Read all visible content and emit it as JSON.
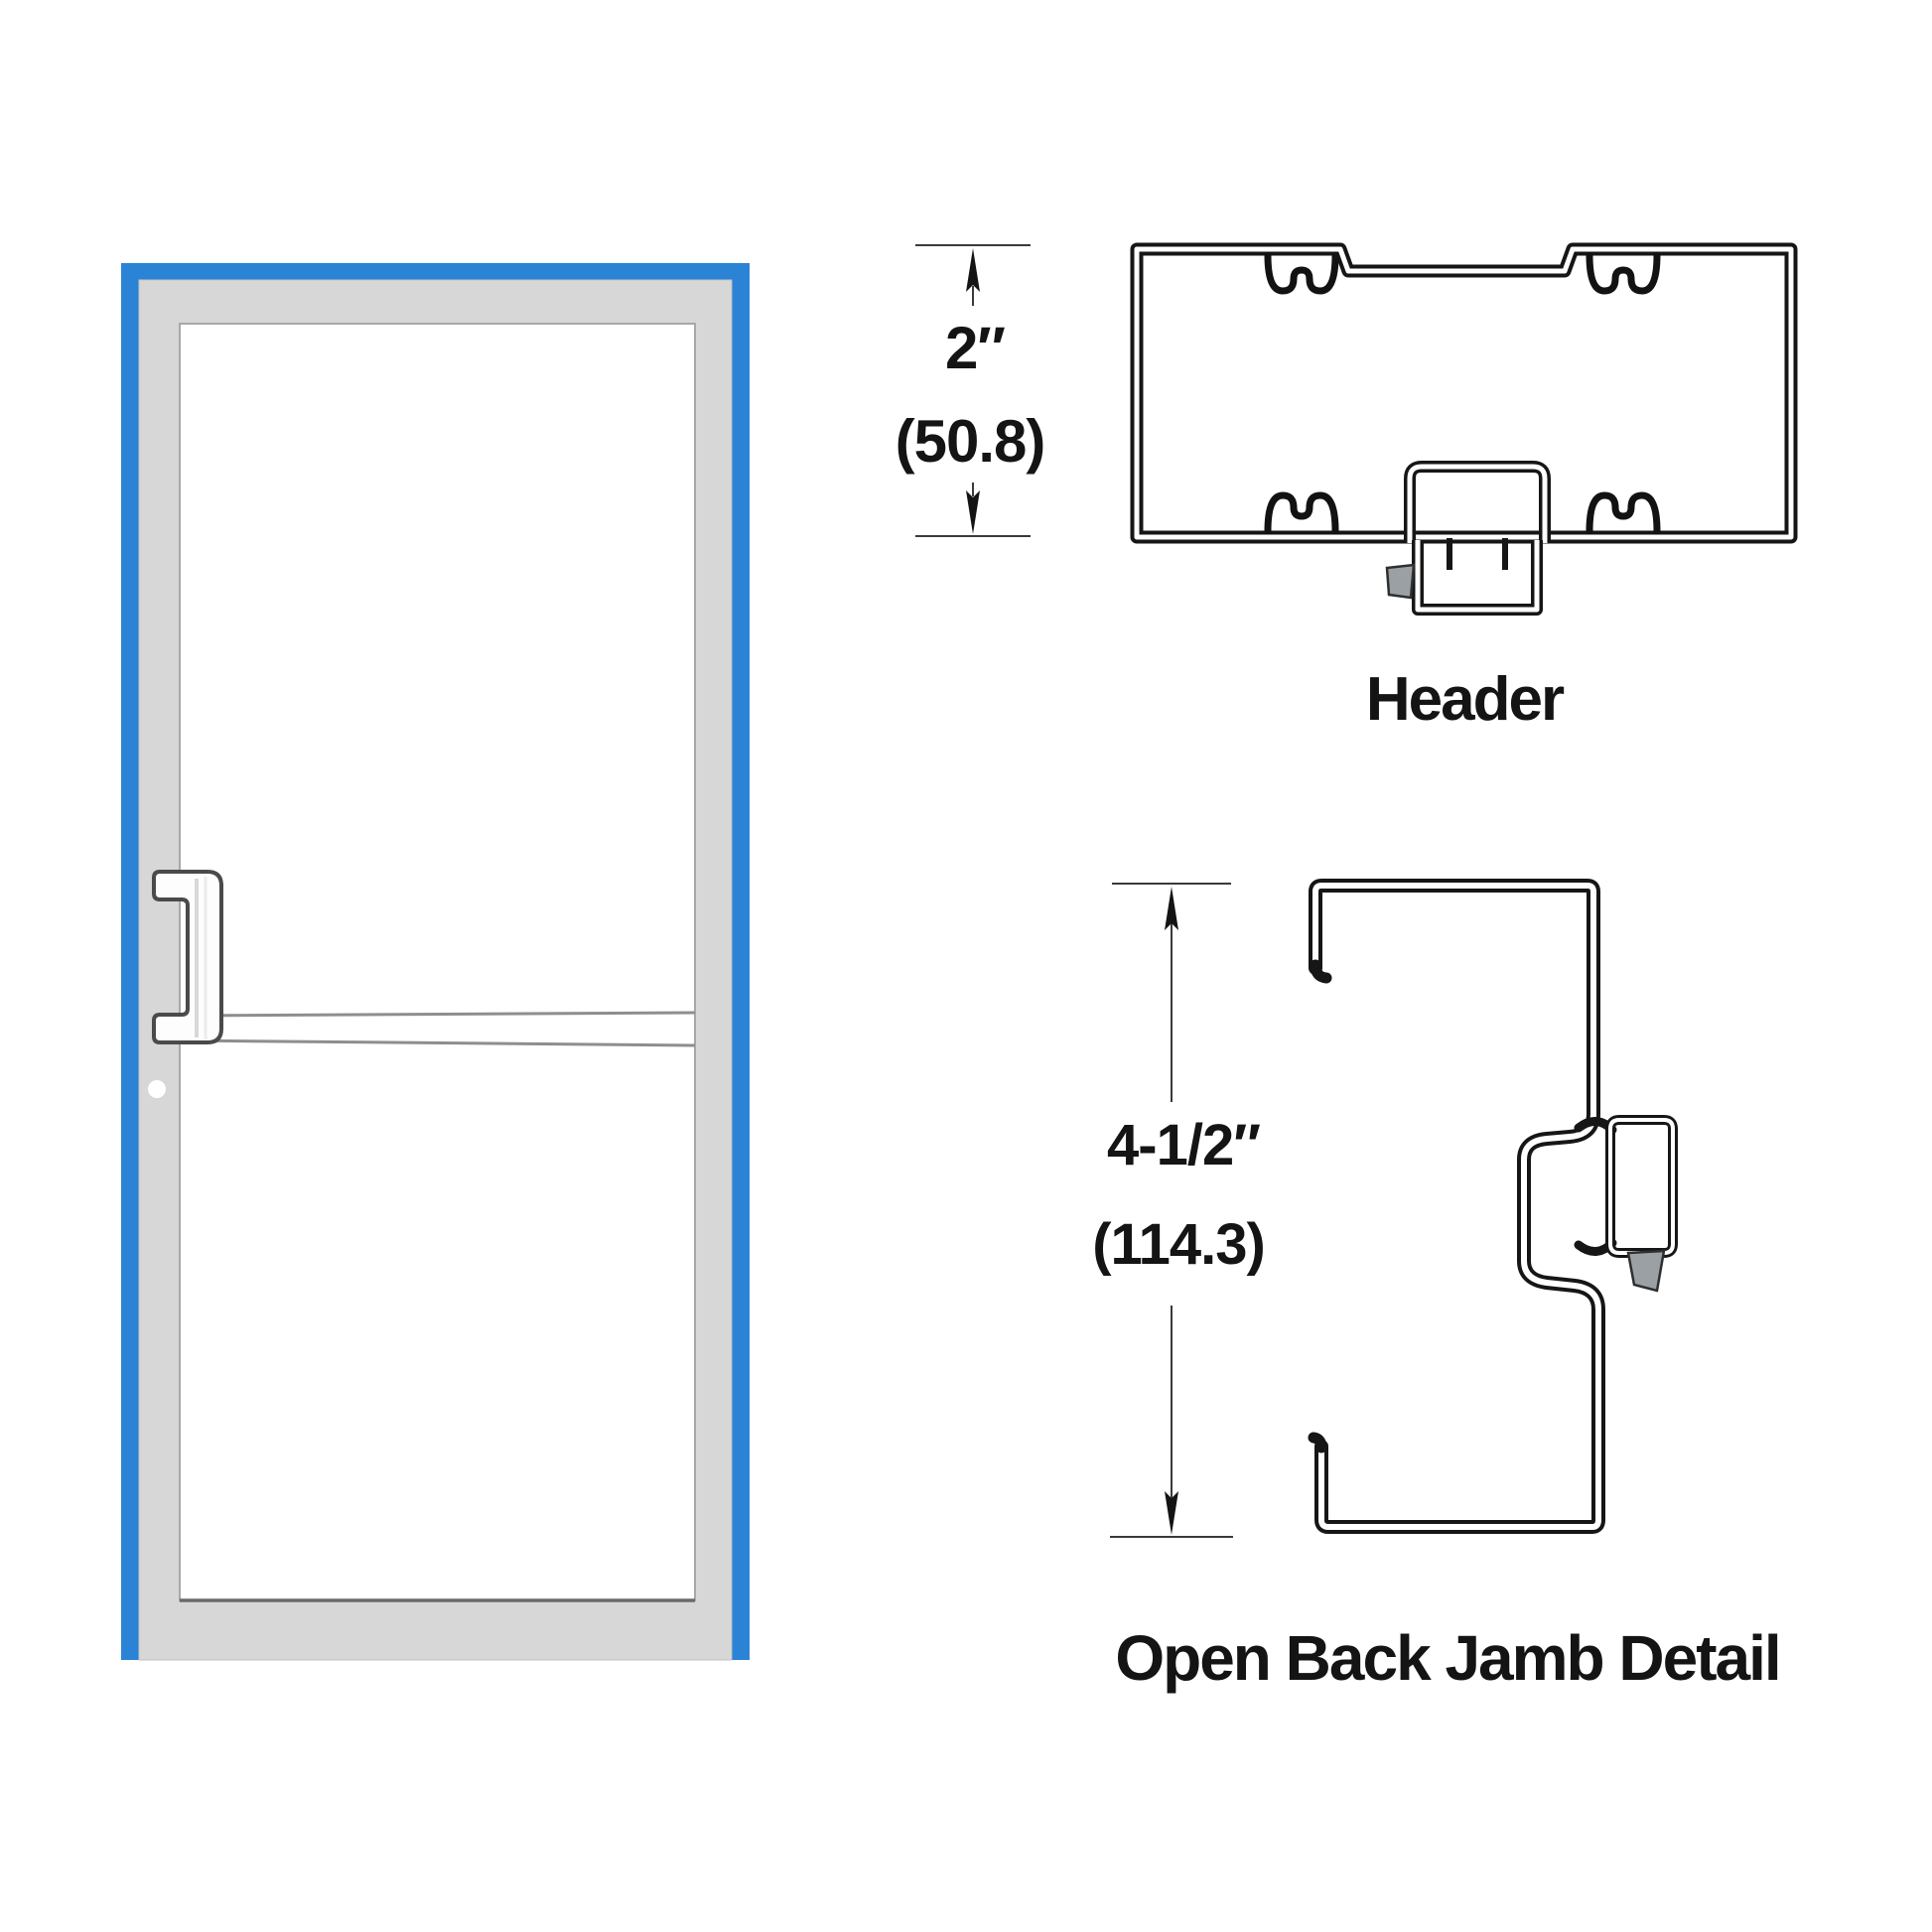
{
  "page": {
    "background": "#ffffff"
  },
  "door": {
    "frame_color": "#2b83d6",
    "leaf_color": "#d7d7d7",
    "glass_color": "#ffffff",
    "parts": {
      "handle": "offset-pull-handle",
      "lock": "cylinder-indicator-dot",
      "mid_rail": "horizontal-mid-rail"
    }
  },
  "details": {
    "header": {
      "imperial": "2″",
      "metric": "(50.8)",
      "caption": "Header"
    },
    "jamb": {
      "imperial": "4-1/2″",
      "metric": "(114.3)",
      "caption": "Open Back Jamb Detail"
    }
  },
  "drawing": {
    "line_color": "#161616",
    "dimension_color": "#3a3a3a",
    "wedge_color": "#9aa0a4"
  }
}
